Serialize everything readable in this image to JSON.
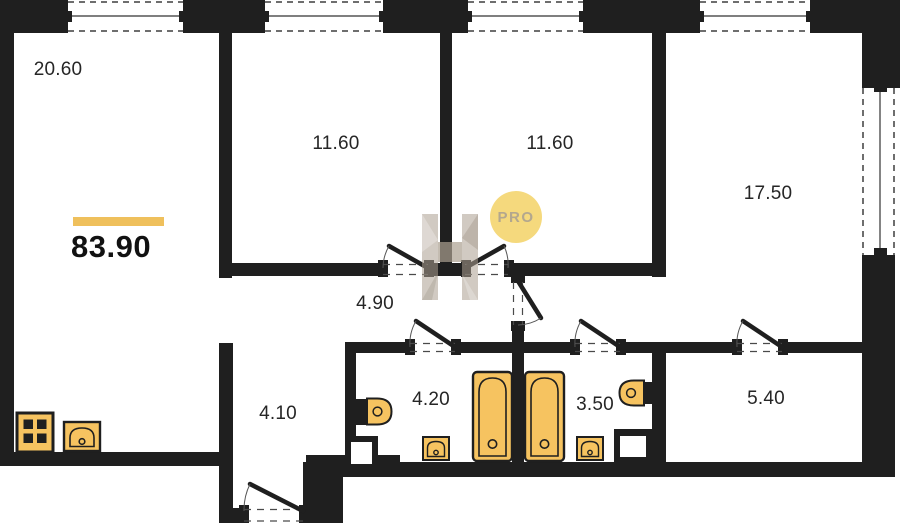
{
  "plan": {
    "total": {
      "area": "83.90"
    },
    "rooms": [
      {
        "name": "living-room",
        "area": "20.60"
      },
      {
        "name": "bedroom-1",
        "area": "11.60"
      },
      {
        "name": "bedroom-2",
        "area": "11.60"
      },
      {
        "name": "living-area",
        "area": "17.50"
      },
      {
        "name": "hallway",
        "area": "4.90"
      },
      {
        "name": "entry-hall",
        "area": "4.10"
      },
      {
        "name": "bathroom-1",
        "area": "4.20"
      },
      {
        "name": "bathroom-2",
        "area": "3.50"
      },
      {
        "name": "storage-room",
        "area": "5.40"
      }
    ],
    "watermark": {
      "label": "PRO"
    },
    "colors": {
      "wall": "#1f1f1f",
      "fixture_fill": "#F6C360",
      "total_accent_line": "#EFC05C",
      "watermark_badge": "#F5D97D",
      "watermark_text": "#B3A78E"
    }
  }
}
